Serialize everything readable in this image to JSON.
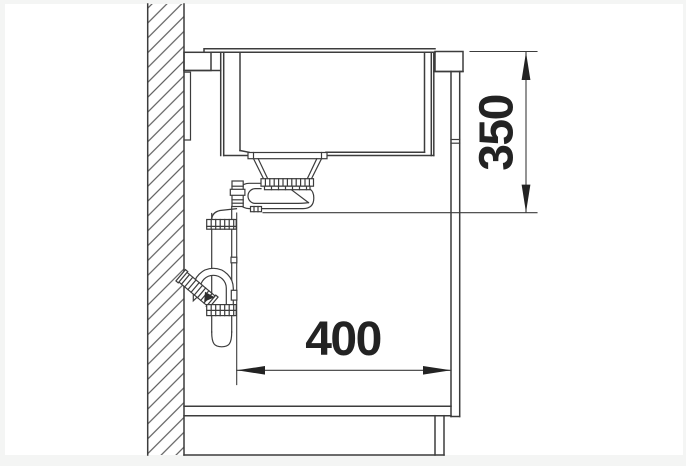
{
  "drawing": {
    "type": "technical-installation-side-view",
    "subject": "kitchen sink with waste trap inside base cabinet",
    "dimensions": {
      "height": {
        "value": "350",
        "orientation": "vertical"
      },
      "width": {
        "value": "400",
        "orientation": "horizontal"
      }
    },
    "components": [
      "wall-section-hatched",
      "countertop-section-hatched",
      "sink-bowl",
      "strainer-waste-flange",
      "knurled-locknut",
      "space-saver-trap",
      "vertical-outlet-pipe",
      "pipe-couplings",
      "wall-outlet-connector-45deg",
      "cabinet-side-panel",
      "cabinet-bottom-board",
      "plinth"
    ],
    "colors": {
      "page_border": "#f4f5f4",
      "paper": "#ffffff",
      "line": "#3c3c3c",
      "hatch": "#474747",
      "dimension_text": "#232323"
    }
  }
}
